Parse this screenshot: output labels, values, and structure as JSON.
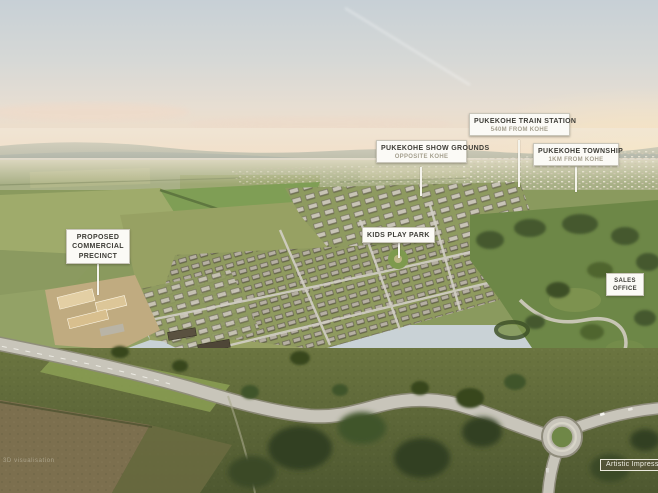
{
  "colors": {
    "callout_bg": "#fbfaf6",
    "callout_border": "#c9c6ba",
    "callout_title": "#3d3c36",
    "callout_subtitle": "#a5a08f",
    "leader_line": "#f5f4ec",
    "badge_bg": "#565538",
    "badge_text": "#f2f1e8",
    "sky_top": "#c7d0d6",
    "sky_horizon": "#f3dfc8",
    "field_green": "#8a9a5e"
  },
  "callouts": {
    "train_station": {
      "title": "PUKEKOHE TRAIN STATION",
      "subtitle": "540M FROM KOHE"
    },
    "township": {
      "title": "PUKEKOHE TOWNSHIP",
      "subtitle": "1KM FROM KOHE"
    },
    "show_grounds": {
      "title": "PUKEKOHE SHOW GROUNDS",
      "subtitle": "OPPOSITE KOHE"
    },
    "play_park": {
      "title": "KIDS PLAY PARK"
    },
    "commercial": {
      "title": "PROPOSED COMMERCIAL PRECINCT"
    },
    "sales_office": {
      "title": "SALES OFFICE"
    }
  },
  "badge": {
    "artistic_impression": "Artistic Impression"
  },
  "watermark": "3D visualisation"
}
